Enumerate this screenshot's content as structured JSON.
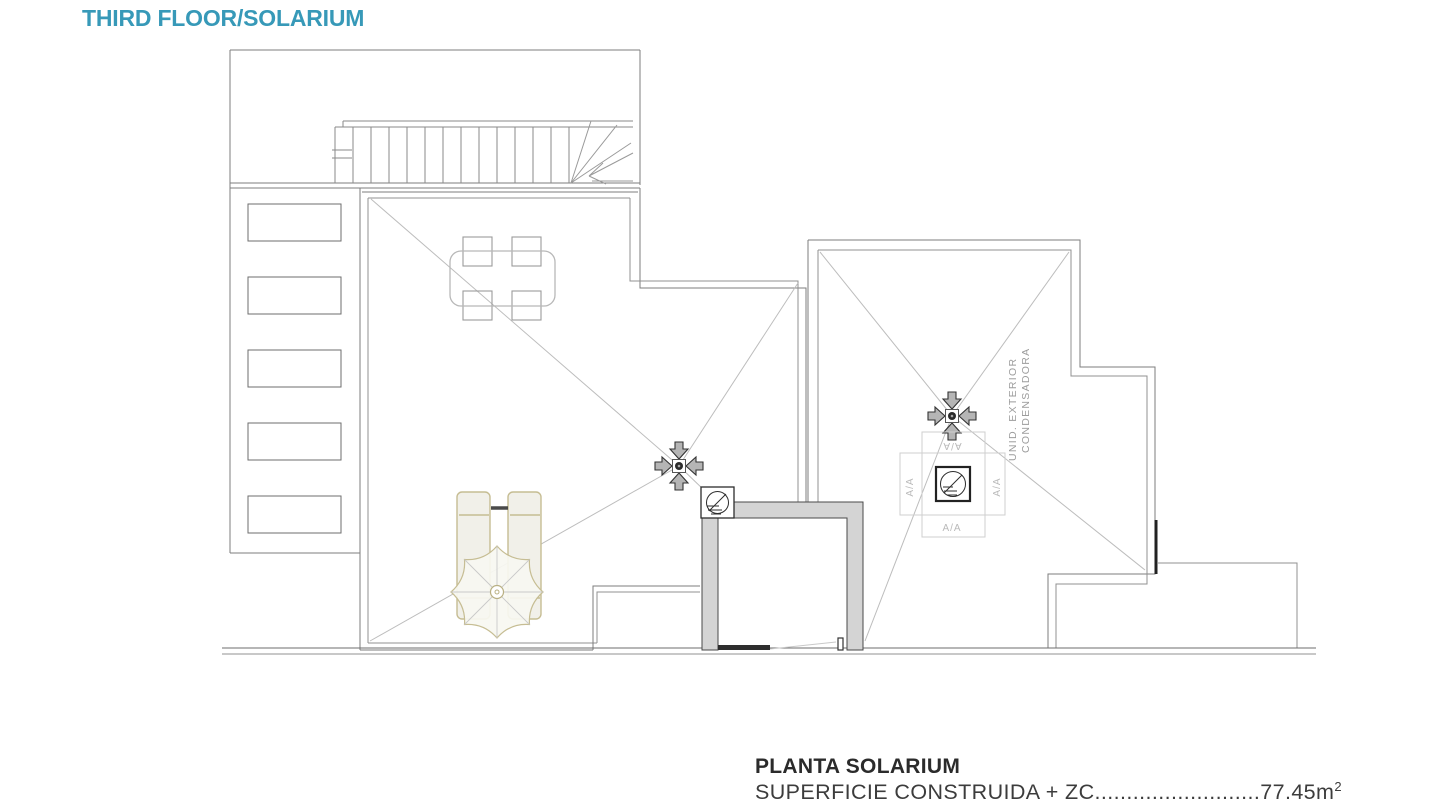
{
  "header": {
    "title": "THIRD FLOOR/SOLARIUM",
    "title_color": "#3799b8"
  },
  "plan": {
    "ac_labels": {
      "top": "A/A",
      "left": "A/A",
      "right": "A/A",
      "bottom": "A/A"
    },
    "condenser_note_line1": "UNID. EXTERIOR",
    "condenser_note_line2": "CONDENSADORA",
    "colors": {
      "wall": "#7d7d7d",
      "slope_line": "#bdbdbd",
      "elevator_wall_fill": "#d4d4d4",
      "furniture_outline_tan": "#c6bd93",
      "furniture_fill": "#f1f0e9",
      "label_gray": "#b9b9b9",
      "dark_accent": "#222222"
    }
  },
  "caption": {
    "plan_name": "PLANTA SOLARIUM",
    "area_label": "SUPERFICIE CONSTRUIDA + ZC",
    "area_dots": "..........................",
    "area_value": "77.45m",
    "area_superscript": "2"
  }
}
